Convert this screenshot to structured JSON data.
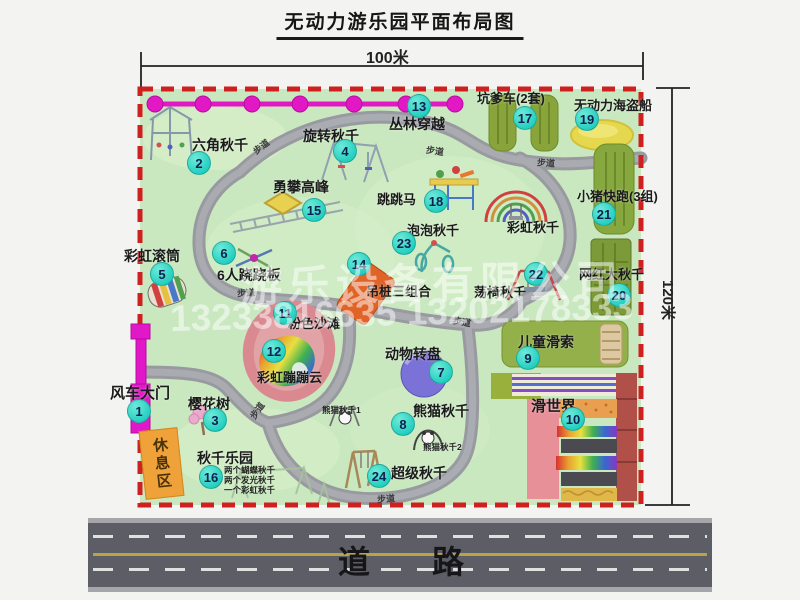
{
  "title": "无动力游乐园平面布局图",
  "dimensions": {
    "width_label": "100米",
    "height_label": "120米"
  },
  "road": {
    "label": "道路"
  },
  "watermark": {
    "company": "游乐设备有限公司",
    "phone": "13233816635 13202178333"
  },
  "path_label": "步道",
  "rest_area_label": "休息区",
  "extra_labels": {
    "rainbow_swing": "彩虹秋千"
  },
  "small_labels": {
    "panda_swing_1": "熊猫秋千1",
    "panda_swing_2": "熊猫秋千2",
    "swing_note_1": "两个蝴蝶秋千",
    "swing_note_2": "两个发光秋千",
    "swing_note_3": "一个彩虹秋千"
  },
  "attractions": [
    {
      "num": "1",
      "name": "风车大门"
    },
    {
      "num": "2",
      "name": "六角秋千"
    },
    {
      "num": "3",
      "name": "樱花树"
    },
    {
      "num": "4",
      "name": "旋转秋千"
    },
    {
      "num": "5",
      "name": "彩虹滚筒"
    },
    {
      "num": "6",
      "name": "6人跷跷板"
    },
    {
      "num": "7",
      "name": "动物转盘"
    },
    {
      "num": "8",
      "name": "熊猫秋千"
    },
    {
      "num": "9",
      "name": "儿童滑索"
    },
    {
      "num": "10",
      "name": "滑世界"
    },
    {
      "num": "11",
      "name": "粉色沙滩"
    },
    {
      "num": "12",
      "name": "彩虹蹦蹦云"
    },
    {
      "num": "13",
      "name": "丛林穿越"
    },
    {
      "num": "14",
      "name": "吊桩三组合"
    },
    {
      "num": "15",
      "name": "勇攀高峰"
    },
    {
      "num": "16",
      "name": "秋千乐园"
    },
    {
      "num": "17",
      "name": "坑爹车(2套)"
    },
    {
      "num": "18",
      "name": "跳跳马"
    },
    {
      "num": "19",
      "name": "无动力海盗船"
    },
    {
      "num": "20",
      "name": "网红大秋千"
    },
    {
      "num": "21",
      "name": "小猪快跑(3组)"
    },
    {
      "num": "22",
      "name": "荡椅秋千"
    },
    {
      "num": "23",
      "name": "泡泡秋千"
    },
    {
      "num": "24",
      "name": "超级秋千"
    }
  ],
  "colors": {
    "map_bg": "#c9e8c0",
    "border_red": "#cf2020",
    "badge_teal": "#23cfc0",
    "magenta": "#e218c4",
    "road_gray": "#5d5d65"
  }
}
